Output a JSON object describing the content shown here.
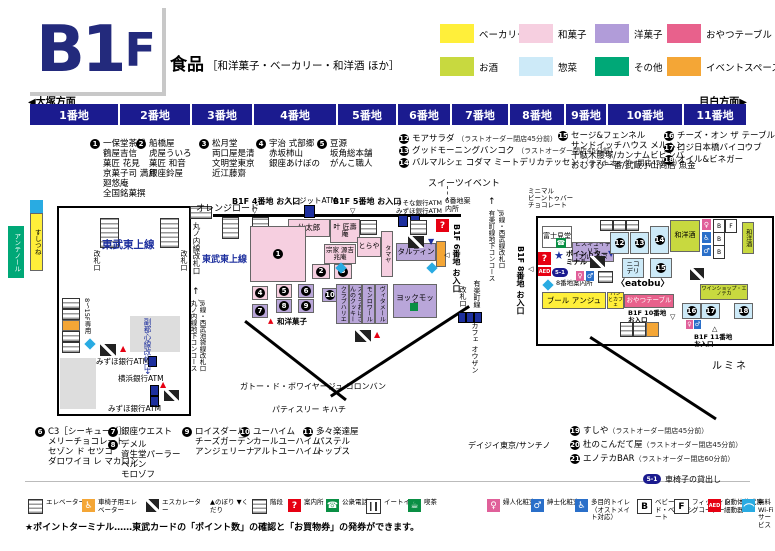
{
  "header": {
    "floor_main": "B1",
    "floor_suffix": "F",
    "category_title": "食品",
    "category_detail": "［和洋菓子・ベーカリー・和洋酒 ほか］"
  },
  "legend": {
    "items": [
      {
        "label": "ベーカリー",
        "color": "#ffef3a"
      },
      {
        "label": "和菓子",
        "color": "#f6cfe0"
      },
      {
        "label": "洋菓子",
        "color": "#b19cd9"
      },
      {
        "label": "おやつテーブル",
        "color": "#e8618c"
      },
      {
        "label": "お酒",
        "color": "#c8d93f"
      },
      {
        "label": "惣菜",
        "color": "#cdeaf8"
      },
      {
        "label": "その他",
        "color": "#00a877"
      },
      {
        "label": "イベントスペース",
        "color": "#f4a636"
      }
    ]
  },
  "nav": {
    "left": "◀大塚方面",
    "right": "目白方面▶",
    "blocks": [
      "1番地",
      "2番地",
      "3番地",
      "4番地",
      "5番地",
      "6番地",
      "7番地",
      "8番地",
      "9番地",
      "10番地",
      "11番地"
    ]
  },
  "directory": {
    "g1": {
      "no": "1",
      "lines": [
        "一保堂茶舗",
        "鶴屋吉信",
        "菓匠 花見",
        "京菓子司 満月",
        "廻悠庵",
        "全国銘菓撰"
      ]
    },
    "g2": {
      "no": "2",
      "lines": [
        "船橋屋",
        "虎屋ういろ",
        "菓匠 和音",
        "銀座鈴屋"
      ]
    },
    "g3": {
      "no": "3",
      "lines": [
        "松月堂",
        "両口屋是清",
        "文明堂東京",
        "近江藤齋"
      ]
    },
    "g4": {
      "no": "4",
      "lines": [
        "宇治 式部郷",
        "赤坂柿山",
        "銀座あけぼの"
      ]
    },
    "g5": {
      "no": "5",
      "lines": [
        "豆源",
        "坂角総本舗",
        "がんこ職人"
      ]
    },
    "g6": {
      "no": "6",
      "lines": [
        "C3［シーキューブ］",
        "メリーチョコレート",
        "セゾン ド セツコ",
        "ダロワイヨ レ マカロン"
      ]
    },
    "g7": {
      "no": "7",
      "lines": [
        "銀座ウエスト"
      ]
    },
    "g8": {
      "no": "8",
      "lines": [
        "デメル",
        "資生堂パーラー",
        "ベルン",
        "モロゾフ"
      ]
    },
    "g9": {
      "no": "9",
      "lines": [
        "ロイスダール",
        "チーズガーデン",
        "アンジェリーナ"
      ]
    },
    "g10": {
      "no": "10",
      "lines": [
        "ユーハイム",
        "カールユーハイム",
        "アルトユーハイム"
      ]
    },
    "g11": {
      "no": "11",
      "lines": [
        "多々楽達屋",
        "パステル",
        "トップス"
      ]
    },
    "g12": {
      "no": "12",
      "name": "モアサラダ",
      "note": "（ラストオーダー閉店45分前）"
    },
    "g13": {
      "no": "13",
      "name": "グッドモーニングバンコク",
      "note": "（ラストオーダー閉店45分前）"
    },
    "g14": {
      "no": "14",
      "name": "バルマルシェ コダマ ミートデリカテッセン",
      "note": "（ラストオーダー閉店45分前）"
    },
    "g15": {
      "no": "15",
      "lines": [
        "セージ&フェンネル",
        "サンドイッチハウス メルヘン",
        "千駄木腰塚/カンナムビビンバ",
        "おむすび一番/武蔵小山商店 魚金"
      ]
    },
    "g16": {
      "no": "16",
      "name": "チーズ・オン ザ テーブル"
    },
    "g17": {
      "no": "17",
      "name": "ロジ日本橋バイコウブ"
    },
    "g18": {
      "no": "18",
      "name": "オイル&ビネガー"
    },
    "g19": {
      "no": "19",
      "name": "すしや",
      "note": "（ラストオーダー閉店45分前）"
    },
    "g20": {
      "no": "20",
      "name": "杜のこんだて屋",
      "note": "（ラストオーダー閉店45分前）"
    },
    "g21": {
      "no": "21",
      "name": "エノテカBAR",
      "note": "（ラストオーダー閉店60分前）"
    },
    "daisy": "デイジイ東京/サンチノ",
    "sweets_event": "スイーツイベント"
  },
  "map": {
    "labels": {
      "orange_road": "オレンジロード",
      "tojo_line": "東武東上線",
      "tojo_line2": "東武東上線",
      "gate_left": "改札口",
      "gate_right": "改札口",
      "marunouchi_gate": "丸ノ内線改札口",
      "marunouchi_concourse": "丸ノ内線地下コンコース",
      "jr_seibu_ikebukuro_gate": "JR線・西武池袋線改札口",
      "fukutoshin_gate": "副都心線改札口",
      "yurakucho_concourse": "有楽町線地下コンコース",
      "jr_seibu_gate": "JR線・西武線改札口",
      "yurakucho_line": "有楽町線",
      "yurakucho_gate": "改札口",
      "elevator_8_15": "8～15F専用",
      "entrance4": "B1F 4番地 お入口",
      "entrance5": "B1F 5番地 お入口",
      "entrance6": "B1F 6番地 お入口",
      "entrance8": "B1F 8番地 お入口",
      "entrance10": "B1F 10番地 お入口",
      "entrance11": "B1F 11番地 お入口",
      "credit_atm": "クレジットATM",
      "risona_atm": "りそな銀行ATM",
      "mizuho_atm_a": "みずほ銀行ATM",
      "mizuho_atm_b": "みずほ銀行ATM",
      "mizuho_atm_c": "みずほ銀行ATM",
      "yokohama_atm": "横浜銀行ATM",
      "info6": "6番地案内所",
      "info8": "8番地案内所",
      "point_terminal": "ポイントターミナル",
      "wayogashi_note": "和洋菓子",
      "sentaro": "仙太郎",
      "kano_shojuan": "叶 匠壽庵",
      "minamoto_kitchoan": "宗家 源吉兆庵",
      "toraya": "とらや",
      "tamaya": "タマヤ",
      "tartine": "タルティン",
      "yokumoku": "ヨックモック",
      "club_harie": "クラブハリエ",
      "stella": "ステラおばさんのクッキー",
      "mon_loire": "モンロワール",
      "wittamer": "ヴィタメール",
      "nico_deli": "ニコ デリ",
      "wayoshu_a": "和洋酒",
      "wayoshu_b": "和洋酒",
      "boul_ange": "ブール アンジュ",
      "oyatsu_table": "おやつテーブル",
      "eatobu": "〈eatobu〉",
      "wine_enoteca": "ワインショップ・エノテカ",
      "fujimido": "富士見堂",
      "biscuiterie": "ビスキュイテリエ",
      "bretonne": "ブルトンヌ",
      "minimal_line1": "ミニマル",
      "minimal_line2": "ビーントゥバー",
      "minimal_line3": "チョコレート",
      "antenor": "アンテノール",
      "sushitsune": "すしつね",
      "lumine": "ルミネ",
      "cafe_ohzan": "カフェ オウザン",
      "gateau_voyage": "ガトー・ド・ボワイヤージュ コロンバン",
      "kihachi": "パティスリー キハチ",
      "pain_cafe": "パンとカフェ"
    }
  },
  "icons": {
    "up": "▲",
    "down": "▼",
    "open_down": "▽",
    "open_up": "△",
    "open_left": "◁",
    "arrow_up": "↑",
    "arrow_down": "↓",
    "question": "?",
    "star": "★",
    "phone": "☎",
    "female": "♀",
    "male": "♂",
    "wheelchair": "♿",
    "cafe": "☕",
    "baby": "B",
    "fitting": "F",
    "aed": "AED"
  },
  "footer": {
    "wheelchair_badge": "5-1",
    "wheelchair_label": "車椅子の貸出し",
    "note": "★ポイントターミナル……東武カードの「ポイント数」の確認と「お買物券」の発券ができます。",
    "legend": [
      {
        "label": "エレベーター"
      },
      {
        "label": "車椅子用エレベーター"
      },
      {
        "label": "エスカレーター"
      },
      {
        "label": "▲のぼり ▼くだり"
      },
      {
        "label": "階段"
      },
      {
        "label": "案内所"
      },
      {
        "label": "公衆電話"
      },
      {
        "label": "イートイン"
      },
      {
        "label": "喫茶"
      },
      {
        "label": "婦人化粧室"
      },
      {
        "label": "紳士化粧室"
      },
      {
        "label": "多目的トイレ（オストメイト対応）"
      },
      {
        "label": "ベビーベッド・ベビーシート"
      },
      {
        "label": "フィッティングコーナー"
      },
      {
        "label": "自動体外式除細動器"
      },
      {
        "label": "無料Wi-Fiサービス"
      }
    ]
  }
}
